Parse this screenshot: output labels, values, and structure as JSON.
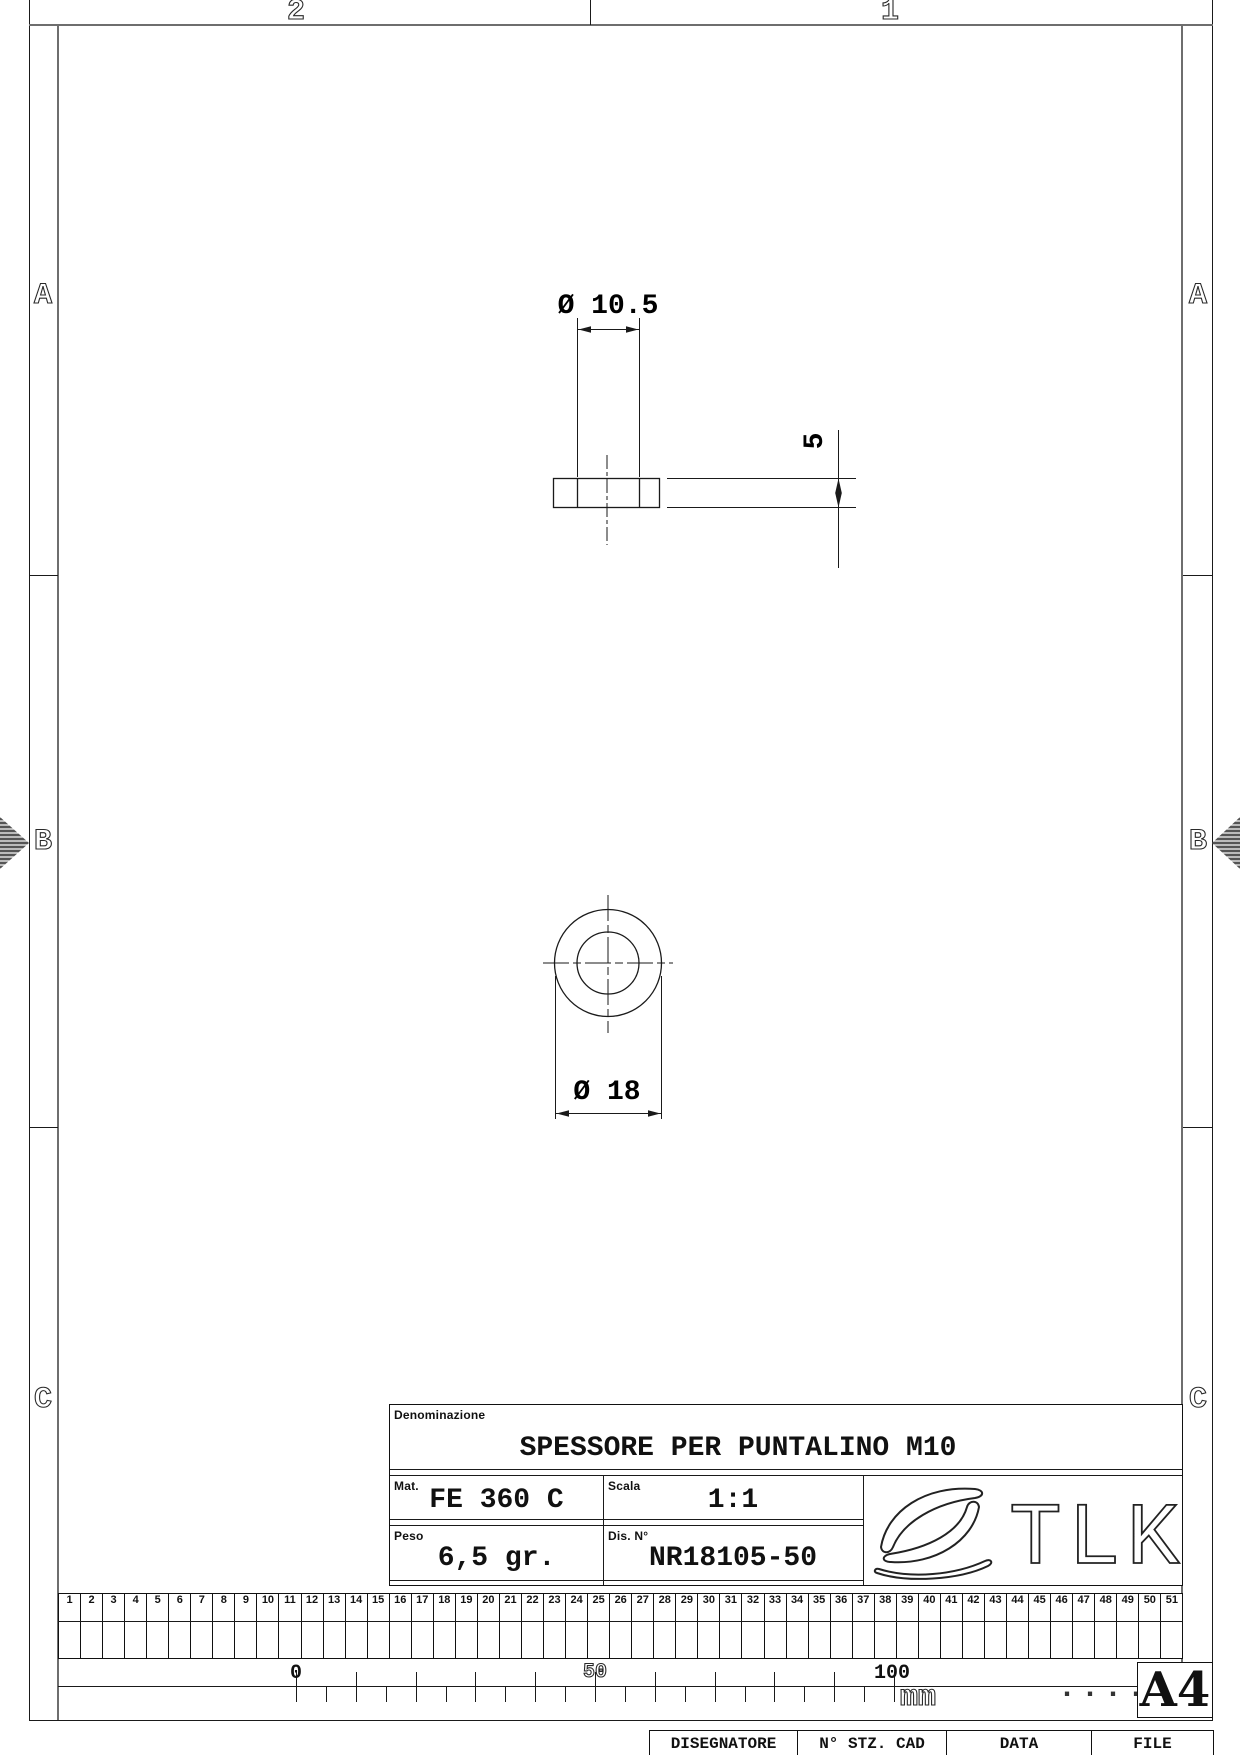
{
  "zones": {
    "top": [
      "2",
      "1"
    ],
    "side": [
      "A",
      "B",
      "C"
    ]
  },
  "drawing": {
    "side_view": {
      "diameter_label": "Ø 10.5",
      "thickness_label": "5"
    },
    "front_view": {
      "diameter_label": "Ø 18"
    }
  },
  "title_block": {
    "denominazione_label": "Denominazione",
    "denominazione_value": "SPESSORE PER PUNTALINO M10",
    "mat_label": "Mat.",
    "mat_value": "FE 360 C",
    "scala_label": "Scala",
    "scala_value": "1:1",
    "peso_label": "Peso",
    "peso_value": "6,5 gr.",
    "dis_label": "Dis. N°",
    "dis_value": "NR18105-50",
    "logo_text": "TLK"
  },
  "ruler": {
    "cells": [
      "1",
      "2",
      "3",
      "4",
      "5",
      "6",
      "7",
      "8",
      "9",
      "10",
      "11",
      "12",
      "13",
      "14",
      "15",
      "16",
      "17",
      "18",
      "19",
      "20",
      "21",
      "22",
      "23",
      "24",
      "25",
      "26",
      "27",
      "28",
      "29",
      "30",
      "31",
      "32",
      "33",
      "34",
      "35",
      "36",
      "37",
      "38",
      "39",
      "40",
      "41",
      "42",
      "43",
      "44",
      "45",
      "46",
      "47",
      "48",
      "49",
      "50",
      "51"
    ]
  },
  "scale_bar": {
    "labels": [
      "0",
      "50",
      "100"
    ],
    "unit": "mm",
    "dots": "......"
  },
  "sheet": {
    "format": "A4"
  },
  "footer": {
    "cells": [
      "DISEGNATORE",
      "N° STZ. CAD",
      "DATA",
      "FILE"
    ]
  }
}
